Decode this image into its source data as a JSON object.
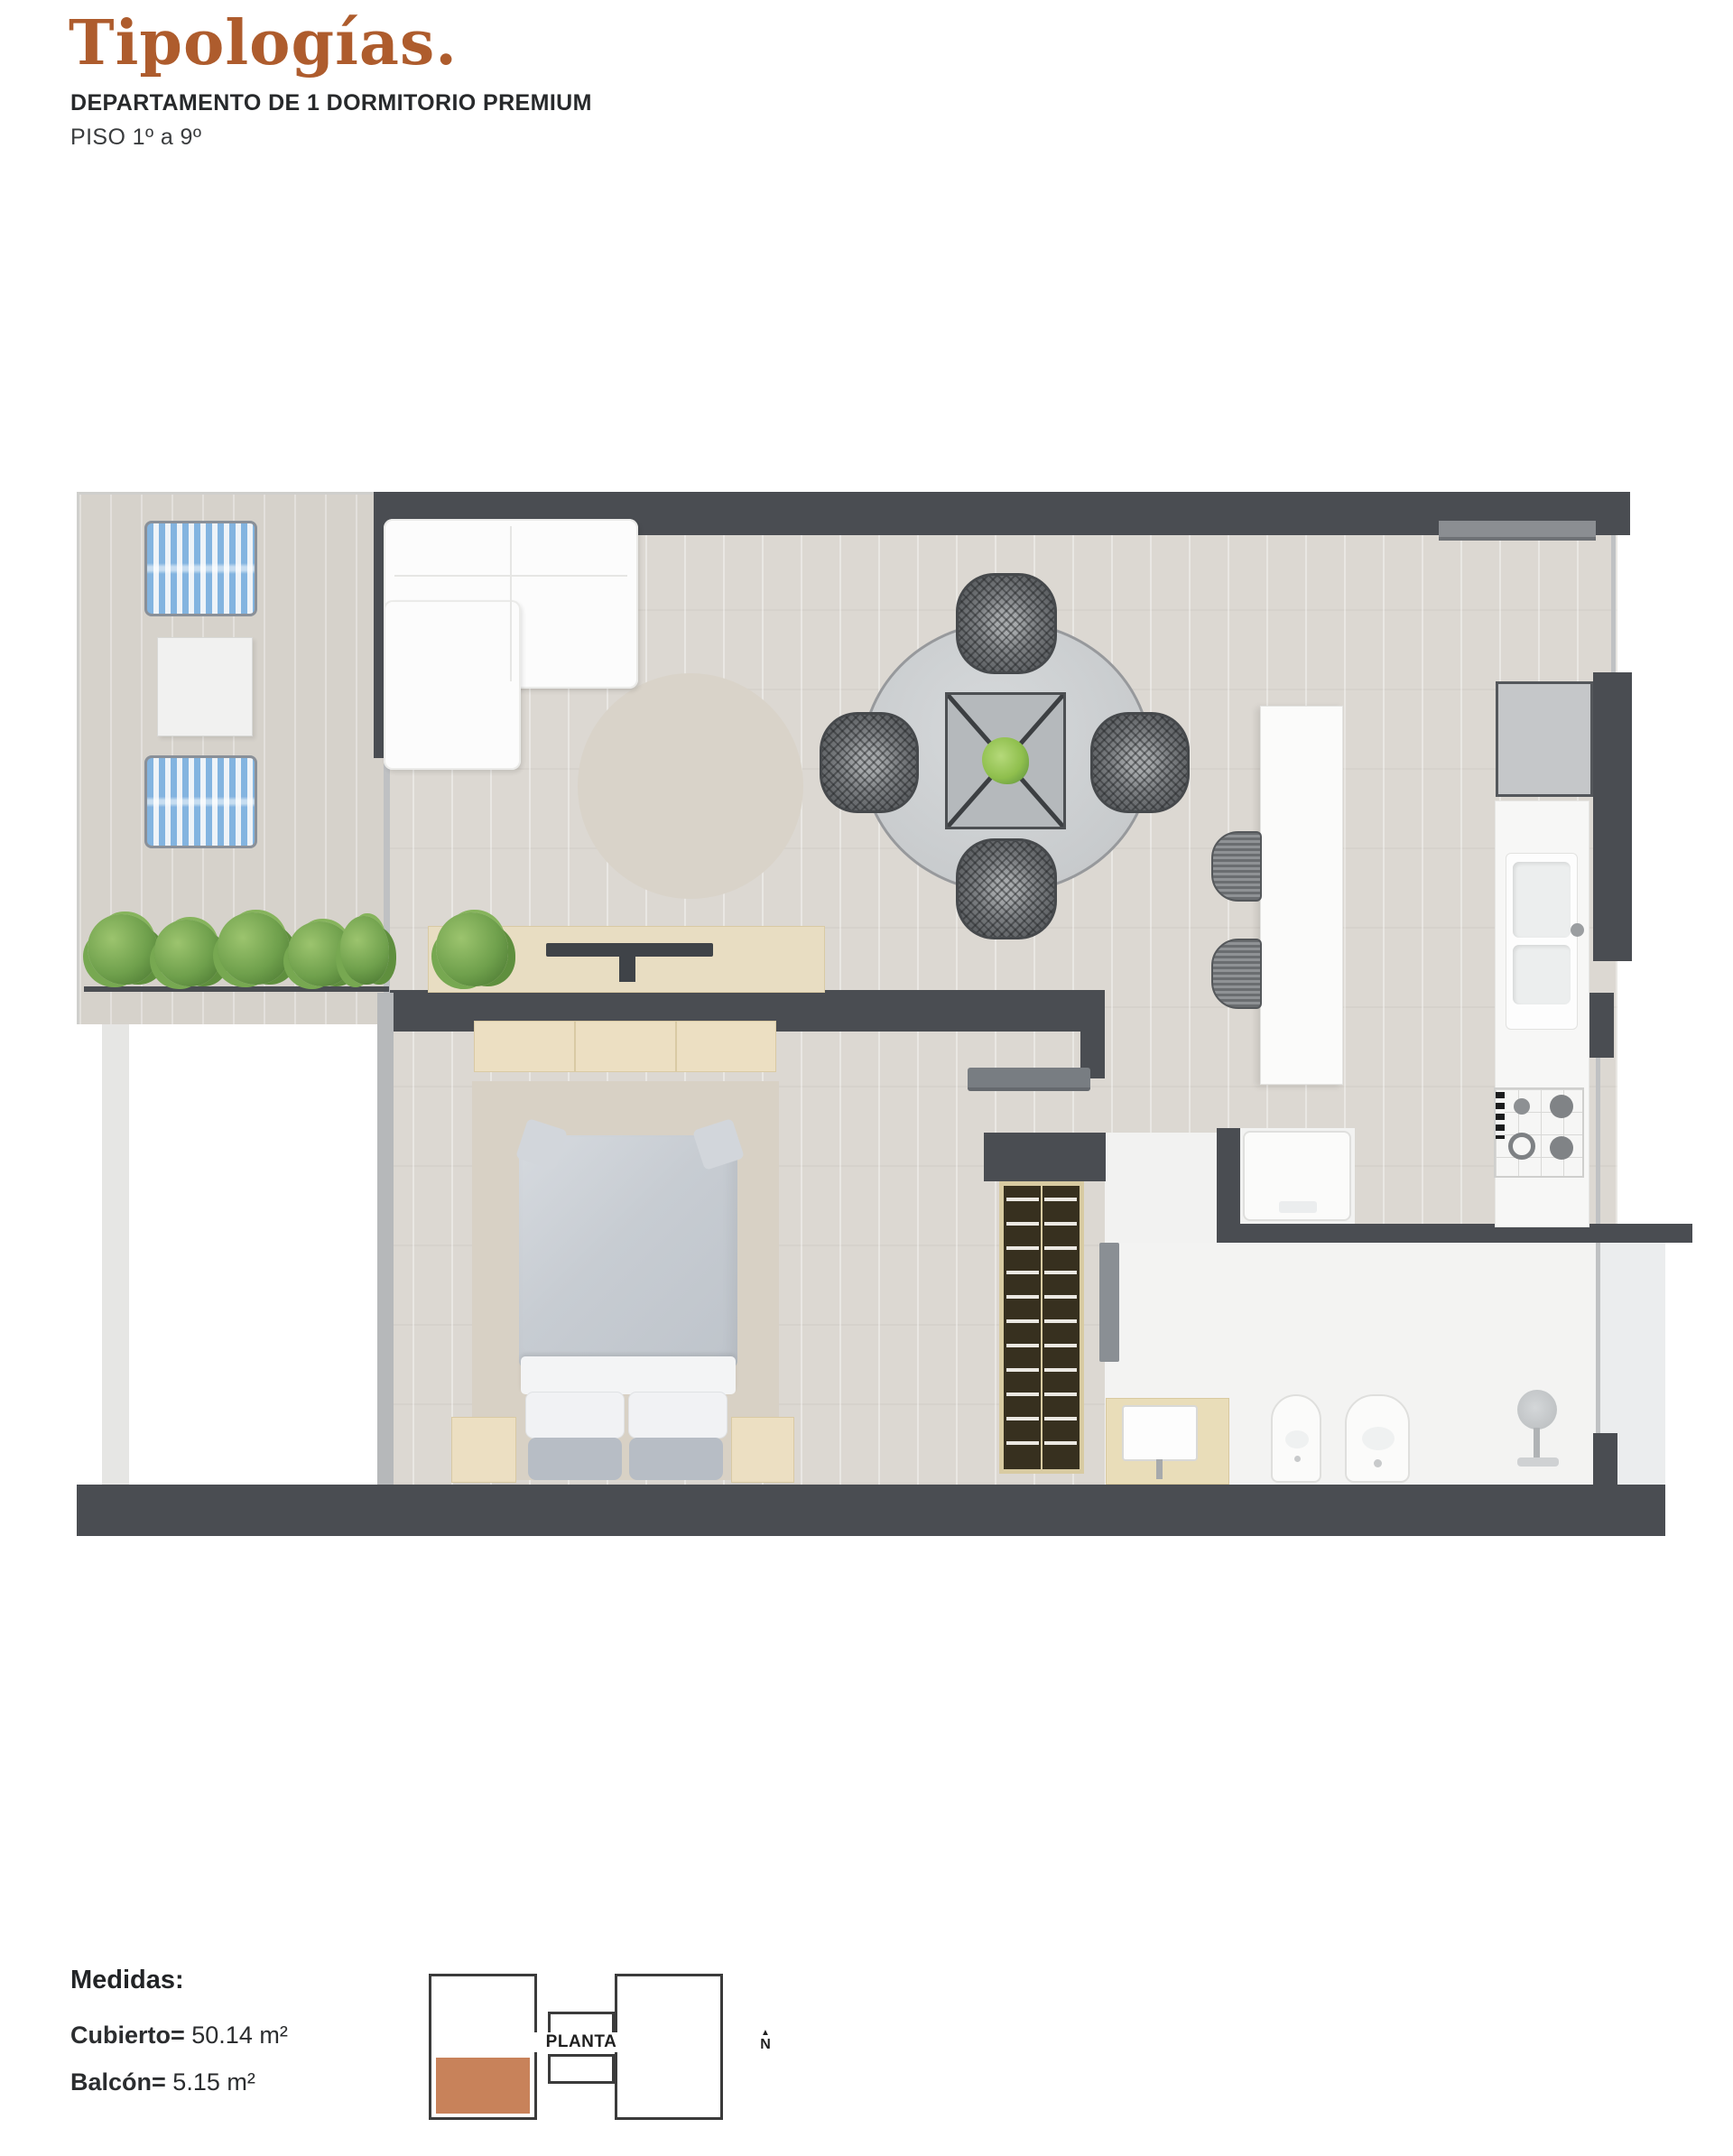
{
  "header": {
    "title": "Tipologías.",
    "title_color": "#ae5c2d",
    "subtitle": "DEPARTAMENTO DE 1 DORMITORIO PREMIUM",
    "floor_range": "PISO 1º a 9º"
  },
  "measures": {
    "heading": "Medidas:",
    "covered_label": "Cubierto=",
    "covered_value": " 50.14 m²",
    "balcony_label": "Balcón=",
    "balcony_value": " 5.15 m²"
  },
  "site_plan": {
    "label": "PLANTA",
    "north_label": "N",
    "highlight_color": "#c8825a"
  },
  "floorplan": {
    "wall_color": "#4a4d52",
    "floor_color": "#dcd8d2",
    "balcony_chair_color": "#83b4e0",
    "plant_color": "#6fa04c",
    "rug_color": "#d8d1c5",
    "wood_furniture_color": "#ecdfc2"
  }
}
